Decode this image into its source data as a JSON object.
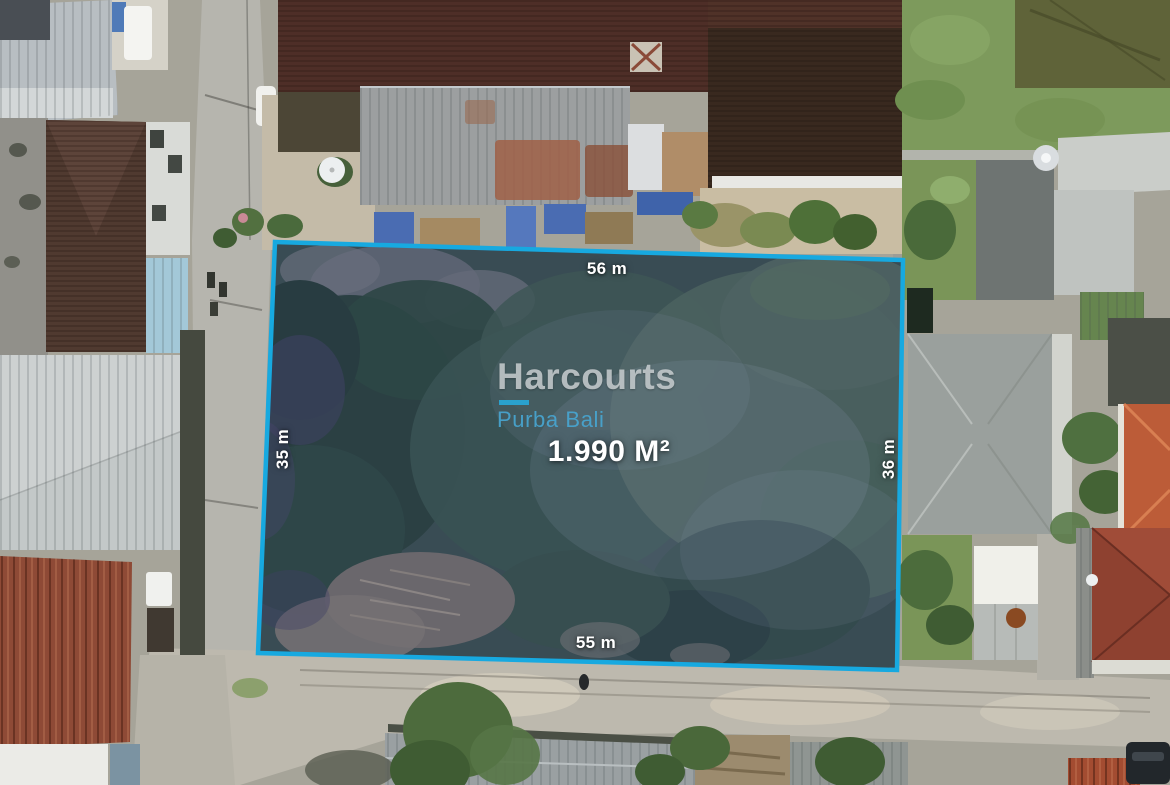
{
  "plot": {
    "area_label": "1.990 M²",
    "dimensions": {
      "top": "56 m",
      "left": "35 m",
      "right": "36 m",
      "bottom": "55 m"
    },
    "boundary_color": "#17A9E0",
    "dimension_label_color": "#FFFFFF"
  },
  "watermark": {
    "brand": "Harcourts",
    "sub_brand": "Purba Bali",
    "brand_color": "#9EA3A5",
    "accent_color": "#2BA7D9"
  }
}
